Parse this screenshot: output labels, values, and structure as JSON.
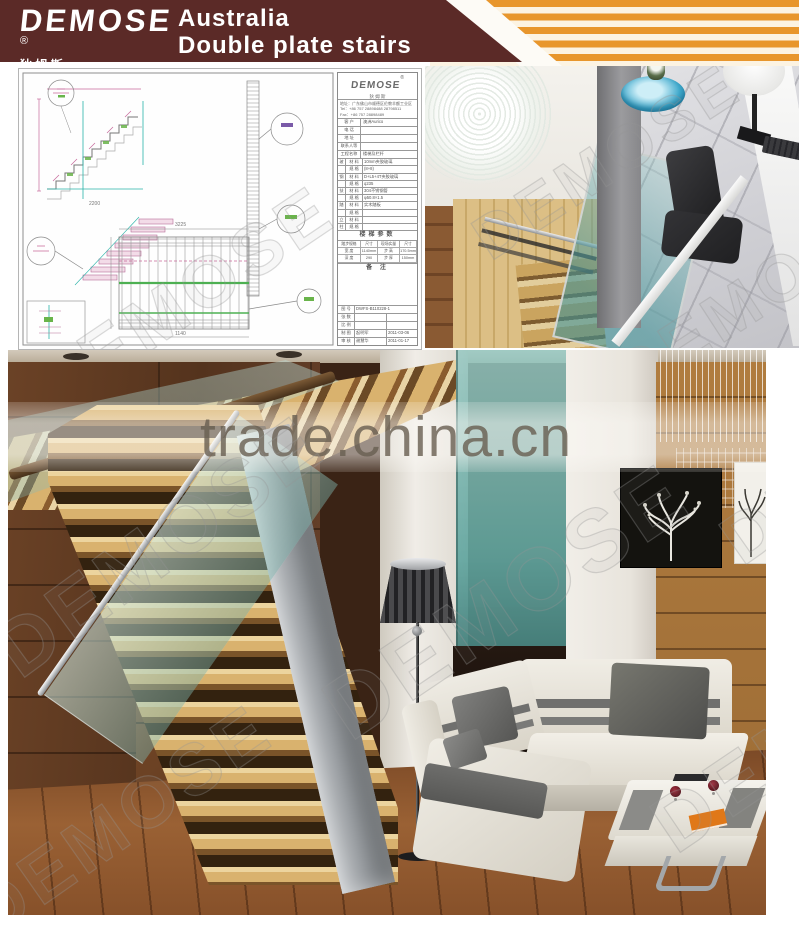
{
  "header": {
    "brand": "DEMOSE",
    "brand_registered": "®",
    "brand_cn": "狄 姆 斯",
    "title_line1": "Australia",
    "title_line2": "Double plate stairs"
  },
  "watermarks": {
    "trade": "trade.china.cn",
    "demose": "DEMOSE"
  },
  "cad": {
    "logo": "DEMOSE",
    "logo_registered": "®",
    "logo_cn": "狄 姆 斯",
    "address": "地址：广东佛山市顺德区伦教羊额工业区",
    "tel": "Tel：+86 757 28898488 28798511",
    "fax": "Fax：+86 757 28898489",
    "customer_rows": [
      {
        "label": "客 户",
        "value": "澳洲Aurico"
      },
      {
        "label": "电 话",
        "value": ""
      },
      {
        "label": "地 址",
        "value": ""
      },
      {
        "label": "联系人等",
        "value": ""
      },
      {
        "label": "工程名称",
        "value": "楼梯及栏杆"
      }
    ],
    "material_rows": [
      {
        "group": "玻",
        "label": "材 料",
        "value": "10mm夹胶玻璃"
      },
      {
        "group": "",
        "label": "规 格",
        "value": "(8+8)"
      },
      {
        "group": "钢",
        "label": "材 料",
        "value": "D+L5+4T夹胶玻璃"
      },
      {
        "group": "",
        "label": "规 格",
        "value": "q235"
      },
      {
        "group": "扶",
        "label": "材 料",
        "value": "304不锈钢管"
      },
      {
        "group": "",
        "label": "规 格",
        "value": "φ50.8×1.5"
      },
      {
        "group": "踏",
        "label": "材 料",
        "value": "实木踏板"
      },
      {
        "group": "",
        "label": "规 格",
        "value": ""
      },
      {
        "group": "立",
        "label": "材 料",
        "value": ""
      },
      {
        "group": "柱",
        "label": "规 格",
        "value": ""
      }
    ],
    "params_title": "楼梯参数",
    "params": {
      "headers": [
        "踏步规格",
        "尺寸",
        "现场实量",
        "尺寸"
      ],
      "rows": [
        [
          "宽 度",
          "1140mm",
          "步 高",
          "170.5mm"
        ],
        [
          "深 度",
          "290",
          "步 厚",
          "150mm"
        ]
      ]
    },
    "notes_title": "备 注",
    "footer_rows": [
      {
        "label": "图 号",
        "value": "DWFS-B110228-1",
        "extra": ""
      },
      {
        "label": "张 数",
        "value": "",
        "extra": ""
      },
      {
        "label": "比 例",
        "value": "",
        "extra": ""
      },
      {
        "label": "制 图",
        "value": "起明军",
        "extra": "2011-03-06"
      },
      {
        "label": "审 核",
        "value": "谢慧华",
        "extra": "2011-01-17"
      }
    ],
    "dims": {
      "d1": "2200",
      "d2": "3225",
      "d3": "1140"
    }
  }
}
